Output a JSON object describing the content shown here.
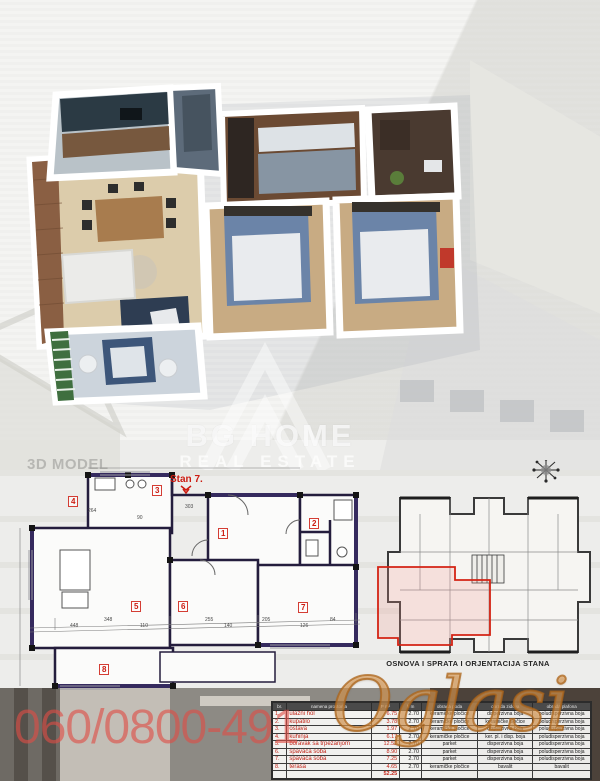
{
  "brand": {
    "line1": "BG HOME",
    "line2": "REAL ESTATE"
  },
  "labels": {
    "model_section": "3D MODEL",
    "plan_unit": "Stan 7.",
    "plan_caption": "OSNOVA I SPRATA I ORJENTACIJA STANA",
    "phone": "060/0800-491",
    "watermark": "Oglasi"
  },
  "colors": {
    "phone_red": "#df4e46",
    "plan_red": "#cc1b10",
    "oglasi_gold": "#d08a3e",
    "table_text_red": "#c22418"
  },
  "floor_plan": {
    "room_numbers": [
      "1",
      "2",
      "3",
      "4",
      "5",
      "6",
      "7",
      "8"
    ],
    "dimensions": [
      "264",
      "303",
      "90",
      "448",
      "348",
      "110",
      "255",
      "140",
      "205",
      "126",
      "84"
    ]
  },
  "table": {
    "headers": [
      "br.",
      "namena prostorija",
      "P m²",
      "h m",
      "obrada poda",
      "obrada zidova",
      "obrada plafona"
    ],
    "rows": [
      [
        "1.",
        "ulazni hol",
        "6.75",
        "2.70",
        "keramičke pločice",
        "disperzivna boja",
        "poludisperzivna boja"
      ],
      [
        "2.",
        "kupatilo",
        "3.78",
        "2.70",
        "keramičke pločice",
        "keramičke pločice",
        "poludisperzivna boja"
      ],
      [
        "3.",
        "ostava",
        "1.97",
        "2.70",
        "keramičke pločice",
        "disperzivna boja",
        "poludisperzivna boja"
      ],
      [
        "4.",
        "kuhinja",
        "6.17",
        "2.70",
        "keramičke pločice",
        "ker. pl. i disp. boja",
        "poludisperzivna boja"
      ],
      [
        "5.",
        "boravak sa trpezarijom",
        "12.52",
        "2.70",
        "parket",
        "disperzivna boja",
        "poludisperzivna boja"
      ],
      [
        "6.",
        "spavaća soba",
        "8.90",
        "2.70",
        "parket",
        "disperzivna boja",
        "poludisperzivna boja"
      ],
      [
        "7.",
        "spavaća soba",
        "7.25",
        "2.70",
        "parket",
        "disperzivna boja",
        "poludisperzivna boja"
      ],
      [
        "8.",
        "terasa",
        "4.65",
        "2.70",
        "keramičke pločice",
        "bavalit",
        "bavalit"
      ]
    ],
    "total": "52.25"
  }
}
